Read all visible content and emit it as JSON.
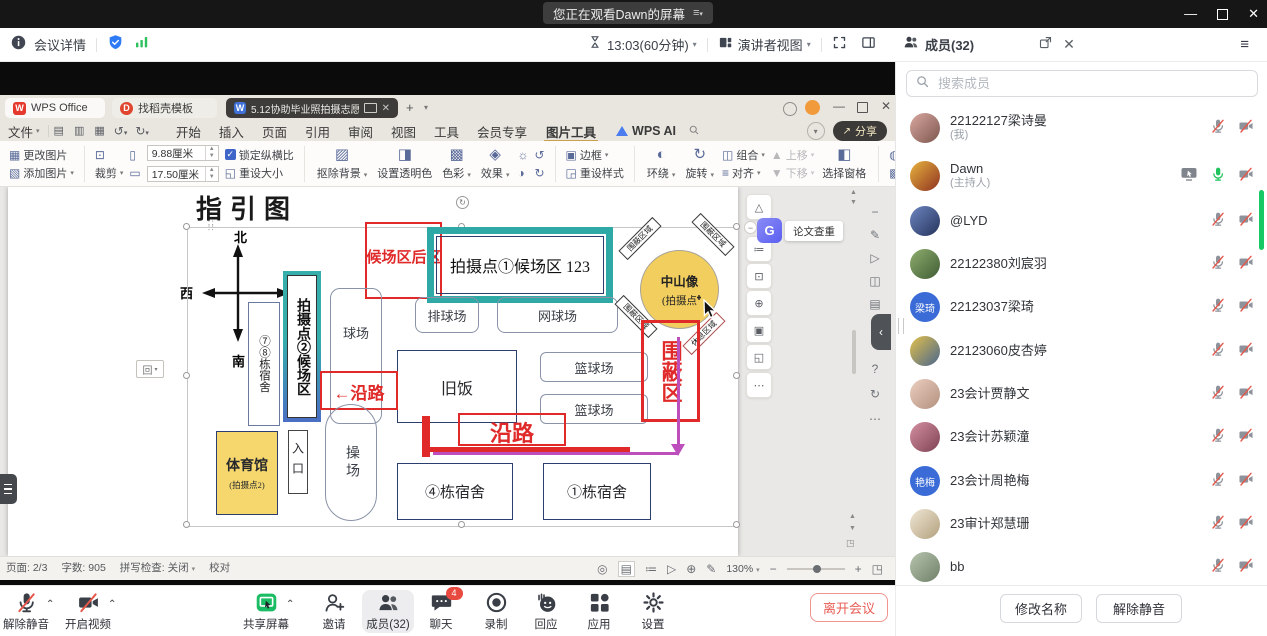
{
  "meeting": {
    "banner": "您正在观看Dawn的屏幕",
    "details": "会议详情",
    "duration": "13:03(60分钟)",
    "view_mode": "演讲者视图",
    "toolbar": [
      {
        "id": "unmute",
        "label": "解除静音",
        "icon": "mic-off",
        "caret": true
      },
      {
        "id": "start-video",
        "label": "开启视频",
        "icon": "cam-off",
        "caret": true
      },
      {
        "id": "share-screen",
        "label": "共享屏幕",
        "icon": "share",
        "caret": true
      },
      {
        "id": "invite",
        "label": "邀请",
        "icon": "invite"
      },
      {
        "id": "members",
        "label": "成员(32)",
        "icon": "members",
        "active": true
      },
      {
        "id": "chat",
        "label": "聊天",
        "icon": "chat",
        "badge": "4"
      },
      {
        "id": "record",
        "label": "录制",
        "icon": "record"
      },
      {
        "id": "react",
        "label": "回应",
        "icon": "react"
      },
      {
        "id": "apps",
        "label": "应用",
        "icon": "apps"
      },
      {
        "id": "settings",
        "label": "设置",
        "icon": "gear"
      }
    ],
    "leave": "离开会议"
  },
  "wps": {
    "tab_app": "WPS Office",
    "tab_docer": "找稻壳模板",
    "tab_doc": "5.12协助毕业照拍摄志愿活动…",
    "file_menu": "文件",
    "menu_items": [
      "开始",
      "插入",
      "页面",
      "引用",
      "审阅",
      "视图",
      "工具",
      "会员专享"
    ],
    "active_tool_tab": "图片工具",
    "ai_label": "WPS AI",
    "share_label": "分享",
    "ribbon": {
      "change_pic": "更改图片",
      "add_pic": "添加图片",
      "crop": "裁剪",
      "width_value": "9.88厘米",
      "height_value": "17.50厘米",
      "lock_ratio": "锁定纵横比",
      "reset_size": "重设大小",
      "remove_bg": "抠除背景",
      "transparent": "设置透明色",
      "color": "色彩",
      "effect": "效果",
      "border": "边框",
      "reset_style": "重设样式",
      "wrap": "环绕",
      "rotate": "旋转",
      "group": "组合",
      "align": "对齐",
      "move_up": "上移",
      "move_down": "下移",
      "selection_pane": "选择窗格",
      "clarify": "清晰化",
      "compress": "压缩图片",
      "batch": "批量处理",
      "convert": "图片转换"
    },
    "floating": {
      "paper_check_icon": "G",
      "paper_check": "论文查重"
    },
    "statusbar": {
      "page": "页面: 2/3",
      "words": "字数: 905",
      "spell": "拼写检查: 关闭",
      "proof": "校对",
      "zoom": "130%"
    }
  },
  "map": {
    "title": "指引图",
    "compass": {
      "n": "北",
      "s": "南",
      "e": "东",
      "w": "西"
    },
    "labels": {
      "hold_back": "候场区后区",
      "spot1": "拍摄点①候场区 123",
      "spot2": "拍摄点②候场区",
      "dorm78": "⑦⑧栋宿舍",
      "court": "球场",
      "volleyball": "排球场",
      "tennis": "网球场",
      "basketball": "篮球场",
      "old_canteen": "旧饭",
      "statue_line1": "中山像",
      "statue_line2": "(拍摄点",
      "enclosure_area": "围蔽区域",
      "rest_area": "休息区域",
      "enclosure": "围蔽区",
      "along_road": "沿路",
      "along_road_arrow": "←沿路",
      "gym_line1": "体育馆",
      "gym_line2": "(拍摄点2)",
      "entrance": "入口",
      "playground": "操场",
      "dorm4": "④栋宿舍",
      "dorm1": "①栋宿舍",
      "anchor": "回"
    }
  },
  "members": {
    "title": "成员(32)",
    "search_placeholder": "搜索成员",
    "list": [
      {
        "name": "22122127梁诗曼",
        "role": "(我)",
        "avatar": {
          "type": "photo",
          "colors": [
            "#d9a8a0",
            "#7c564e"
          ]
        },
        "mic": "muted",
        "cam": "off"
      },
      {
        "name": "Dawn",
        "role": "(主持人)",
        "avatar": {
          "type": "photo",
          "colors": [
            "#e8b43e",
            "#8e3220"
          ]
        },
        "mic": "on",
        "cam": "off",
        "sharing": true
      },
      {
        "name": "@LYD",
        "avatar": {
          "type": "photo",
          "colors": [
            "#6d86c0",
            "#25335c"
          ]
        },
        "mic": "muted",
        "cam": "off"
      },
      {
        "name": "22122380刘宸羽",
        "avatar": {
          "type": "photo",
          "colors": [
            "#8fae6e",
            "#3f5c34"
          ]
        },
        "mic": "muted",
        "cam": "off"
      },
      {
        "name": "22123037梁琦",
        "avatar": {
          "type": "text",
          "text": "梁琦",
          "colors": [
            "#3b6bd6",
            "#3b6bd6"
          ]
        },
        "mic": "muted",
        "cam": "off"
      },
      {
        "name": "22123060皮杏婷",
        "avatar": {
          "type": "photo",
          "colors": [
            "#e3c04a",
            "#49668e"
          ]
        },
        "mic": "muted",
        "cam": "off"
      },
      {
        "name": "23会计贾静文",
        "avatar": {
          "type": "photo",
          "colors": [
            "#eccfc0",
            "#b2907e"
          ]
        },
        "mic": "muted",
        "cam": "off"
      },
      {
        "name": "23会计苏颖潼",
        "avatar": {
          "type": "photo",
          "colors": [
            "#d490a2",
            "#7e4252"
          ]
        },
        "mic": "muted",
        "cam": "off"
      },
      {
        "name": "23会计周艳梅",
        "avatar": {
          "type": "text",
          "text": "艳梅",
          "colors": [
            "#3b6bd6",
            "#3b6bd6"
          ]
        },
        "mic": "muted",
        "cam": "off"
      },
      {
        "name": "23审计郑慧珊",
        "avatar": {
          "type": "photo",
          "colors": [
            "#efe6d4",
            "#b3a17e"
          ]
        },
        "mic": "muted",
        "cam": "off"
      },
      {
        "name": "bb",
        "avatar": {
          "type": "photo",
          "colors": [
            "#b7c5ae",
            "#6f7f68"
          ]
        },
        "mic": "muted",
        "cam": "off"
      }
    ],
    "rename": "修改名称",
    "unmute": "解除静音"
  }
}
